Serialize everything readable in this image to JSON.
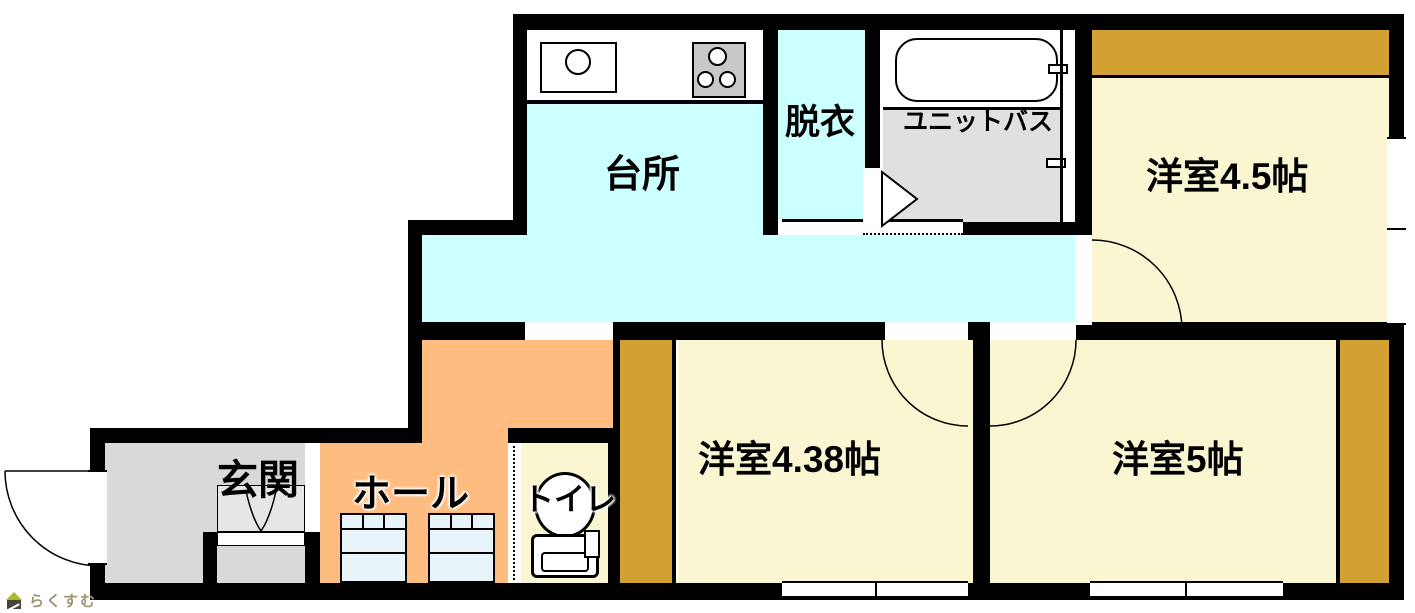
{
  "plan_title": "apartment-floor-plan",
  "rooms": {
    "kitchen": {
      "label": "台所"
    },
    "dressing_room": {
      "label": "脱衣"
    },
    "unit_bath": {
      "label": "ユニットバス"
    },
    "western_room_45": {
      "label": "洋室4.5帖"
    },
    "western_room_438": {
      "label": "洋室4.38帖"
    },
    "western_room_5": {
      "label": "洋室5帖"
    },
    "entrance": {
      "label": "玄関"
    },
    "hall": {
      "label": "ホール"
    },
    "toilet": {
      "label": "トイレ"
    }
  },
  "logo": {
    "text": "らくすむ",
    "icon": "house-icon"
  },
  "colors": {
    "wall": "#000000",
    "kitchen_floor": "#CCFFFF",
    "room_floor": "#FAF6D2",
    "closet": "#D2A033",
    "hall_floor": "#FFBC80",
    "entrance_floor": "#D9D9D9",
    "bath_floor": "#E0E0E0",
    "cabinet_fill": "#E9F3FA",
    "logo_text": "#A39274",
    "logo_roof": "#ADBA2E"
  },
  "fixtures": [
    "kitchen-sink",
    "gas-stove",
    "bathtub",
    "toilet-bowl",
    "storage-cabinet",
    "shoe-cabinet",
    "entrance-step"
  ]
}
